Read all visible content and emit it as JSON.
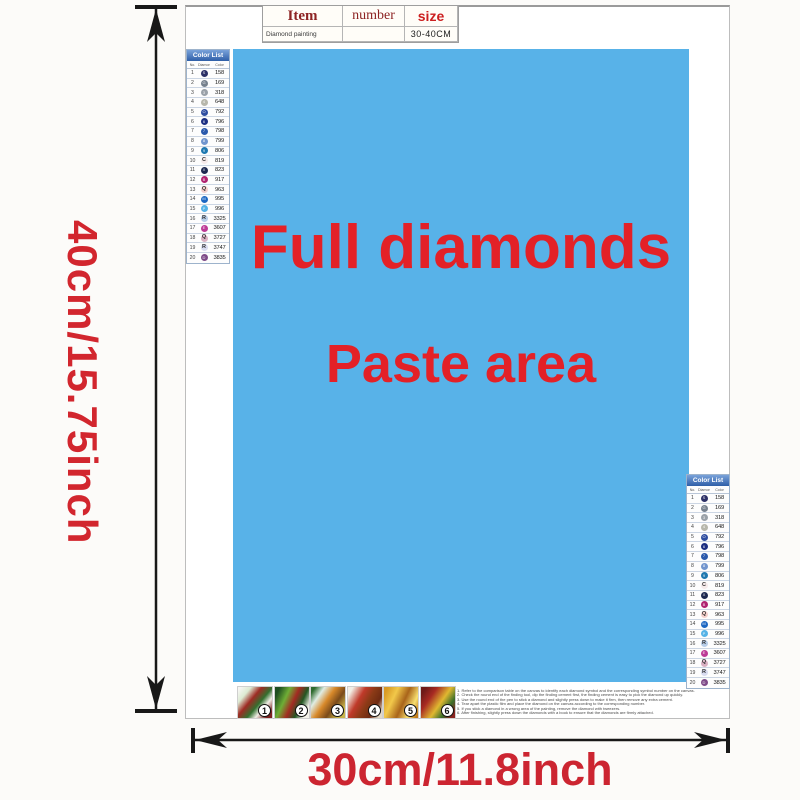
{
  "ruler": {
    "height_label": "40cm/15.75inch",
    "width_label": "30cm/11.8inch",
    "label_color": "#d2262e"
  },
  "item_table": {
    "col_item": "Item",
    "col_number": "number",
    "col_size": "size",
    "row_item": "Diamond painting",
    "row_number": "",
    "row_size": "30-40CM"
  },
  "paste_area": {
    "line1": "Full diamonds",
    "line2": "Paste area",
    "bg_color": "#58b2e8",
    "text_color": "#e32127"
  },
  "color_list": {
    "title": "Color List",
    "col_no": "No.",
    "col_diamond": "Diamond",
    "col_color": "Color",
    "rows": [
      {
        "no": "1",
        "symbol": "S",
        "code": "158",
        "color": "#2b2f66",
        "light": false
      },
      {
        "no": "2",
        "symbol": "G",
        "code": "169",
        "color": "#76818e",
        "light": false
      },
      {
        "no": "3",
        "symbol": "3",
        "code": "318",
        "color": "#9aa1a8",
        "light": false
      },
      {
        "no": "4",
        "symbol": "4",
        "code": "648",
        "color": "#b7b7ab",
        "light": false
      },
      {
        "no": "5",
        "symbol": "O",
        "code": "792",
        "color": "#2e4da0",
        "light": false
      },
      {
        "no": "6",
        "symbol": "6",
        "code": "796",
        "color": "#1c2f82",
        "light": false
      },
      {
        "no": "7",
        "symbol": "7",
        "code": "798",
        "color": "#2a59ac",
        "light": false
      },
      {
        "no": "8",
        "symbol": "8",
        "code": "799",
        "color": "#7195ce",
        "light": false
      },
      {
        "no": "9",
        "symbol": "9",
        "code": "806",
        "color": "#1f78b0",
        "light": false
      },
      {
        "no": "10",
        "symbol": "C",
        "code": "819",
        "color": "#f6eaea",
        "light": true
      },
      {
        "no": "11",
        "symbol": "X",
        "code": "823",
        "color": "#1c2850",
        "light": false
      },
      {
        "no": "12",
        "symbol": "B",
        "code": "917",
        "color": "#b02270",
        "light": false
      },
      {
        "no": "13",
        "symbol": "Q",
        "code": "963",
        "color": "#f4cfcb",
        "light": true
      },
      {
        "no": "14",
        "symbol": "M",
        "code": "995",
        "color": "#1d67c2",
        "light": false
      },
      {
        "no": "15",
        "symbol": "P",
        "code": "996",
        "color": "#54b2e6",
        "light": false
      },
      {
        "no": "16",
        "symbol": "R",
        "code": "3325",
        "color": "#b7cde8",
        "light": true
      },
      {
        "no": "17",
        "symbol": "E",
        "code": "3607",
        "color": "#bd3a96",
        "light": false
      },
      {
        "no": "18",
        "symbol": "Q",
        "code": "3727",
        "color": "#dab0c2",
        "light": true
      },
      {
        "no": "19",
        "symbol": "R",
        "code": "3747",
        "color": "#d8dbf0",
        "light": true
      },
      {
        "no": "20",
        "symbol": "D",
        "code": "3835",
        "color": "#7e4b88",
        "light": false
      }
    ]
  },
  "steps": [
    {
      "num": "1"
    },
    {
      "num": "2"
    },
    {
      "num": "3"
    },
    {
      "num": "4"
    },
    {
      "num": "5"
    },
    {
      "num": "6"
    }
  ],
  "instructions": [
    "1. Refer to the comparison table on the canvas to identify each diamond symbol and the corresponding symbol number on the canvas.",
    "2. Check the round end of the finding tool, dip the finding cement first, the finding cement is easy to pick the diamond up quickly.",
    "3. Use the round end of the pen to stick a diamond and slightly press down to make it firm, then remove any extra cement.",
    "4. Tear apart the plastic film and place the diamond on the canvas according to the corresponding number.",
    "5. If you stick a diamond in a wrong area of the painting, remove the diamond with tweezers.",
    "6. After finishing, slightly press down the diamonds with a book to ensure that the diamonds are firmly attached."
  ]
}
